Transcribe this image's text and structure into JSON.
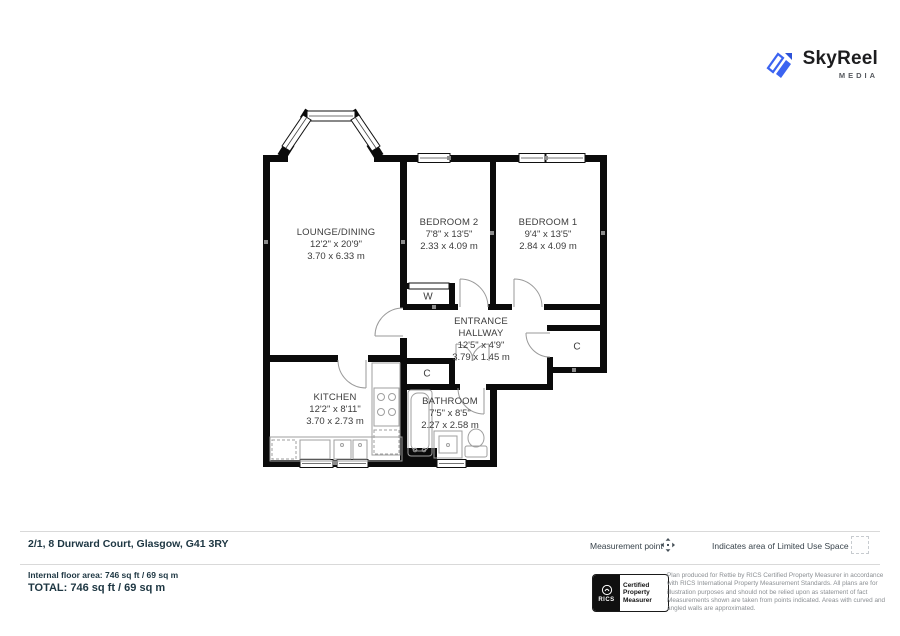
{
  "brand": {
    "name": "SkyReel",
    "tagline": "MEDIA"
  },
  "plan": {
    "rooms": [
      {
        "name": "LOUNGE/DINING",
        "imperial": "12'2\" x 20'9\"",
        "metric": "3.70 x 6.33 m"
      },
      {
        "name": "BEDROOM 2",
        "imperial": "7'8\" x 13'5\"",
        "metric": "2.33 x 4.09 m"
      },
      {
        "name": "BEDROOM 1",
        "imperial": "9'4\" x 13'5\"",
        "metric": "2.84 x 4.09 m"
      },
      {
        "name": "ENTRANCE HALLWAY",
        "imperial": "12'5\" x 4'9\"",
        "metric": "3.79 x 1.45 m"
      },
      {
        "name": "KITCHEN",
        "imperial": "12'2\" x 8'11\"",
        "metric": "3.70 x 2.73 m"
      },
      {
        "name": "BATHROOM",
        "imperial": "7'5\" x 8'5\"",
        "metric": "2.27 x 2.58 m"
      }
    ],
    "closets": {
      "wardrobe": "W",
      "hall_cupboard": "C",
      "linen_cupboard": "C"
    }
  },
  "footer": {
    "address": "2/1, 8 Durward Court, Glasgow, G41 3RY",
    "legend": {
      "measurement_point": "Measurement point",
      "limited_use": "Indicates area of  Limited Use Space"
    },
    "internal_area": "Internal floor area: 746 sq ft / 69 sq m",
    "total": "TOTAL: 746 sq ft / 69 sq m",
    "rics": {
      "org": "RICS",
      "certification": "Certified Property Measurer"
    },
    "disclaimer": "Plan produced for Rettie by RICS Certified Property Measurer in accordance with RICS International Property Measurement Standards.  All plans are for illustration purposes and should not be relied upon as statement of fact Measurements shown are taken from points indicated. Areas with curved and angled walls are approximated."
  },
  "colors": {
    "brand_blue": "#3B63F1",
    "wall": "#0b0b0b",
    "text_dark": "#1d3642"
  }
}
